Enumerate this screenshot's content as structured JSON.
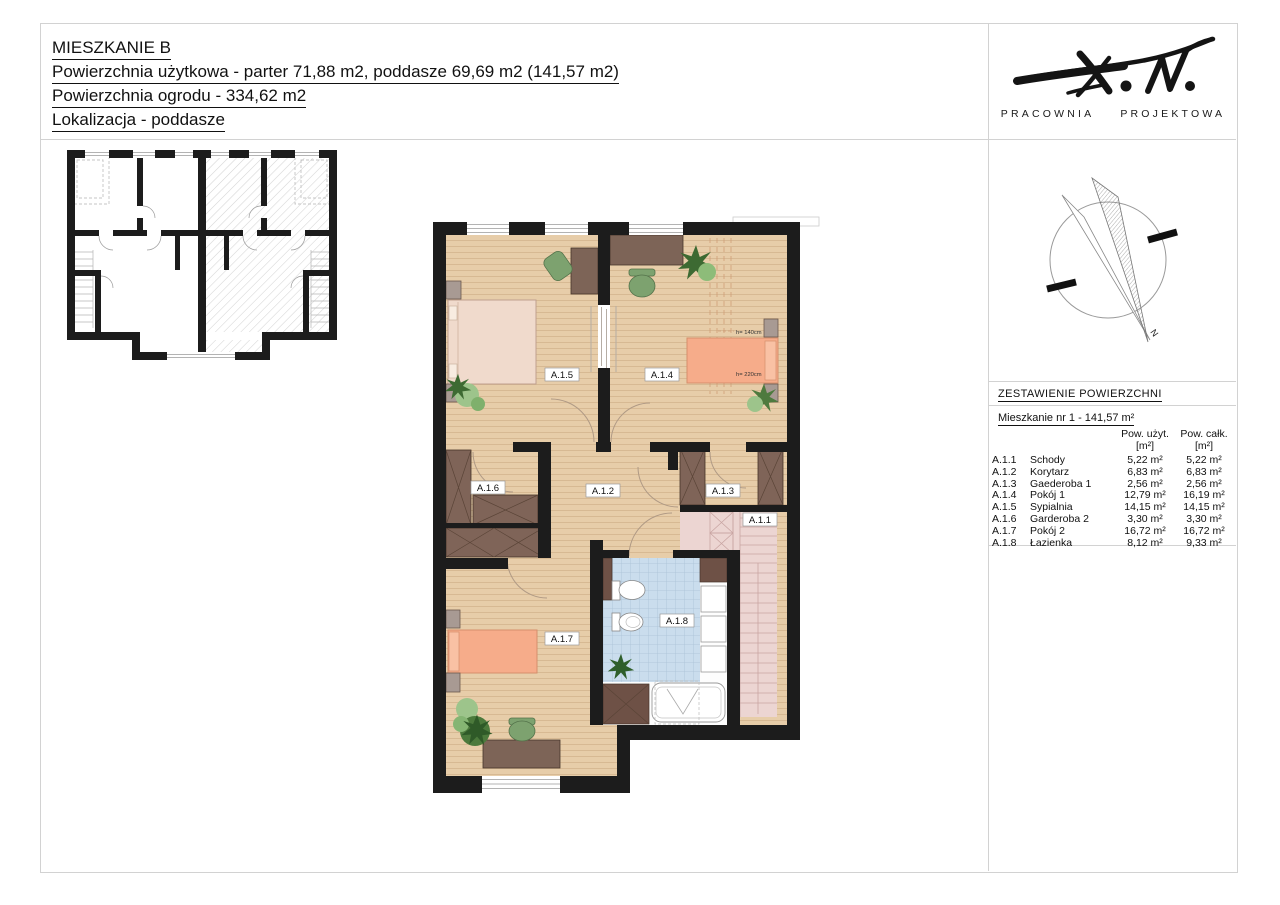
{
  "title_block": {
    "lines": [
      "MIESZKANIE B",
      "Powierzchnia użytkowa - parter 71,88 m2, poddasze 69,69 m2 (141,57 m2)",
      "Powierzchnia ogrodu - 334,62 m2",
      "Lokalizacja - poddasze"
    ]
  },
  "brand": {
    "studio_words": [
      "PRACOWNIA",
      "PROJEKTOWA"
    ]
  },
  "compass": {
    "north": "N"
  },
  "summary": {
    "header": "ZESTAWIENIE POWIERZCHNI",
    "subtitle": "Mieszkanie nr 1 - 141,57 m²",
    "col_uzyt": "Pow. użyt. [m²]",
    "col_calk": "Pow. całk. [m²]",
    "rows": [
      {
        "code": "A.1.1",
        "name": "Schody",
        "uzyt": "5,22 m²",
        "calk": "5,22 m²"
      },
      {
        "code": "A.1.2",
        "name": "Korytarz",
        "uzyt": "6,83 m²",
        "calk": "6,83 m²"
      },
      {
        "code": "A.1.3",
        "name": "Gaederoba 1",
        "uzyt": "2,56 m²",
        "calk": "2,56 m²"
      },
      {
        "code": "A.1.4",
        "name": "Pokój 1",
        "uzyt": "12,79 m²",
        "calk": "16,19 m²"
      },
      {
        "code": "A.1.5",
        "name": "Sypialnia",
        "uzyt": "14,15 m²",
        "calk": "14,15 m²"
      },
      {
        "code": "A.1.6",
        "name": "Garderoba 2",
        "uzyt": "3,30 m²",
        "calk": "3,30 m²"
      },
      {
        "code": "A.1.7",
        "name": "Pokój 2",
        "uzyt": "16,72 m²",
        "calk": "16,72 m²"
      },
      {
        "code": "A.1.8",
        "name": "Łazienka",
        "uzyt": "8,12 m²",
        "calk": "9,33 m²"
      }
    ]
  },
  "plan": {
    "labels": [
      {
        "id": "A.1.5"
      },
      {
        "id": "A.1.4"
      },
      {
        "id": "A.1.6"
      },
      {
        "id": "A.1.2"
      },
      {
        "id": "A.1.3"
      },
      {
        "id": "A.1.1"
      },
      {
        "id": "A.1.7"
      },
      {
        "id": "A.1.8"
      }
    ],
    "annotations": {
      "h_upper": "h= 140cm",
      "h_lower": "h= 220cm"
    }
  },
  "palette": {
    "wall": "#1c1c1c",
    "floor_wood": "#e7cda9",
    "bathroom_tile": "#cadded",
    "stairs_floor": "#ecd5d2",
    "bed_pink": "#f0dacc",
    "bed_orange": "#f6ac8a",
    "furniture_brown": "#7f6458",
    "cabinet_gray": "#a89a93",
    "plant_green": "#6f9e5f"
  }
}
